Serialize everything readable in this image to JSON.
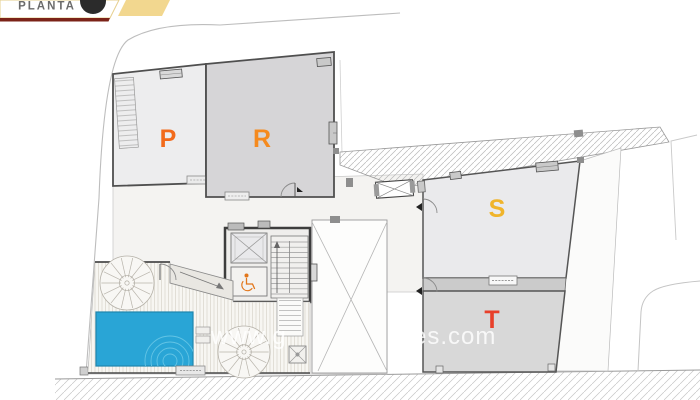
{
  "banner": {
    "title": "PLANTA",
    "ribbon_color": "#f2d78f",
    "underline_color": "#7b2318",
    "badge_color": "#2b2b2b"
  },
  "watermark": {
    "left": "www.g",
    "right": "ates.com"
  },
  "rooms": {
    "p": {
      "label": "P",
      "color": "#f26a1b"
    },
    "r": {
      "label": "R",
      "color": "#f58a1e"
    },
    "s": {
      "label": "S",
      "color": "#f0b42a"
    },
    "t": {
      "label": "T",
      "color": "#e8402a"
    }
  },
  "pool": {
    "color": "#29a5d6"
  }
}
